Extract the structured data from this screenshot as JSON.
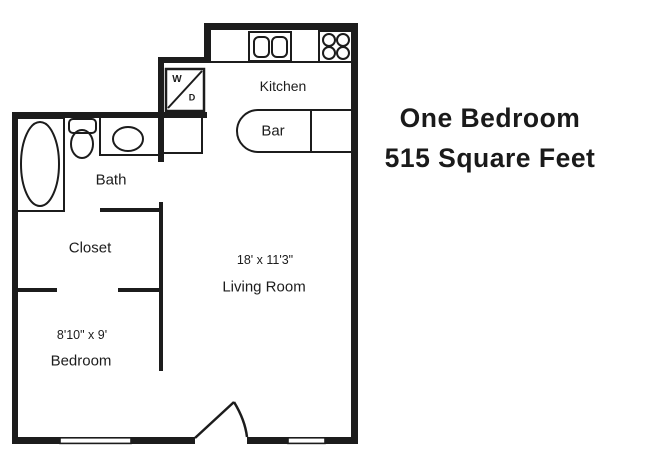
{
  "title": {
    "line1": "One Bedroom",
    "line2": "515 Square Feet"
  },
  "rooms": {
    "kitchen": "Kitchen",
    "bar": "Bar",
    "bath": "Bath",
    "closet": "Closet",
    "living_room": "Living Room",
    "living_room_dims": "18' x 11'3\"",
    "bedroom": "Bedroom",
    "bedroom_dims": "8'10\" x 9'"
  },
  "appliances": {
    "washer": "W",
    "dryer": "D"
  },
  "colors": {
    "ink": "#1c1c1c",
    "background": "#ffffff"
  }
}
